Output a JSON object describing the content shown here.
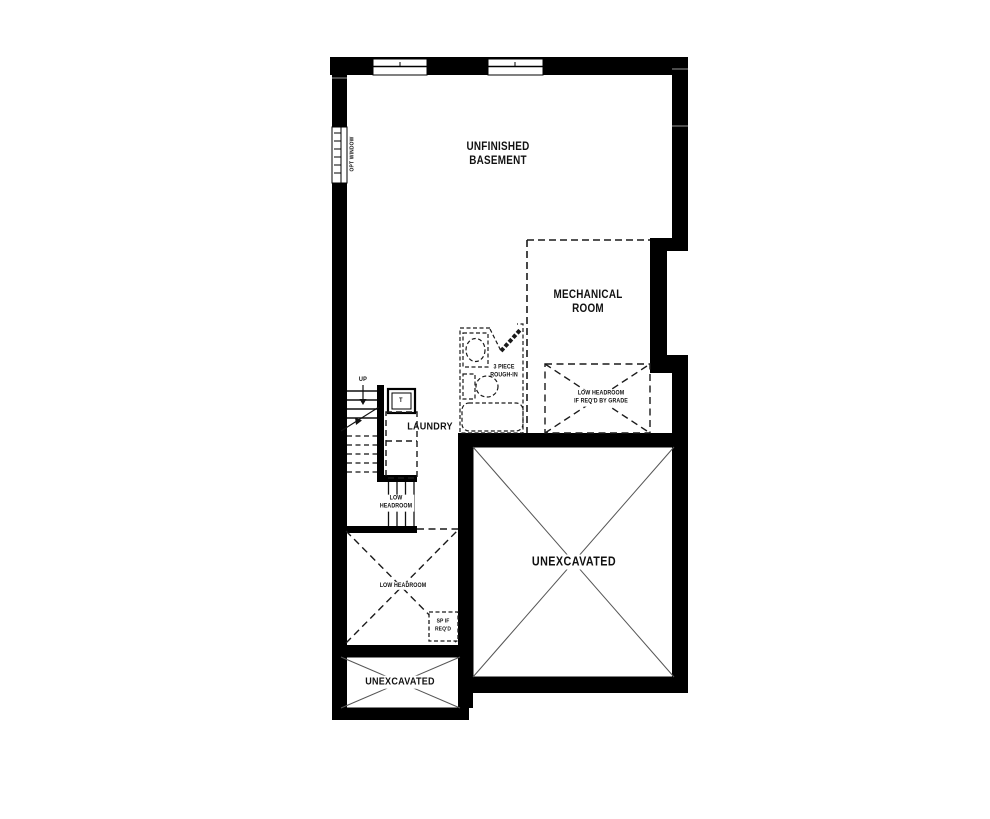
{
  "labels": {
    "unfinished_basement": "UNFINISHED\nBASEMENT",
    "mechanical_room": "MECHANICAL\nROOM",
    "laundry": "LAUNDRY",
    "unexcavated_main": "UNEXCAVATED",
    "unexcavated_lower": "UNEXCAVATED",
    "rough_in": "3 PIECE\nROUGH-IN",
    "low_headroom_grade": "LOW HEADROOM\nIF REQ'D BY GRADE",
    "low_headroom_stairs": "LOW\nHEADROOM",
    "low_headroom_crawl": "LOW HEADROOM",
    "sump_pump": "SP IF\nREQ'D",
    "up": "UP",
    "opt_window": "OPT WINDOW",
    "laundry_tub": "T"
  },
  "colors": {
    "wall": "#000000",
    "line": "#1a1a1a",
    "thin_line": "#555555",
    "background": "#ffffff"
  }
}
